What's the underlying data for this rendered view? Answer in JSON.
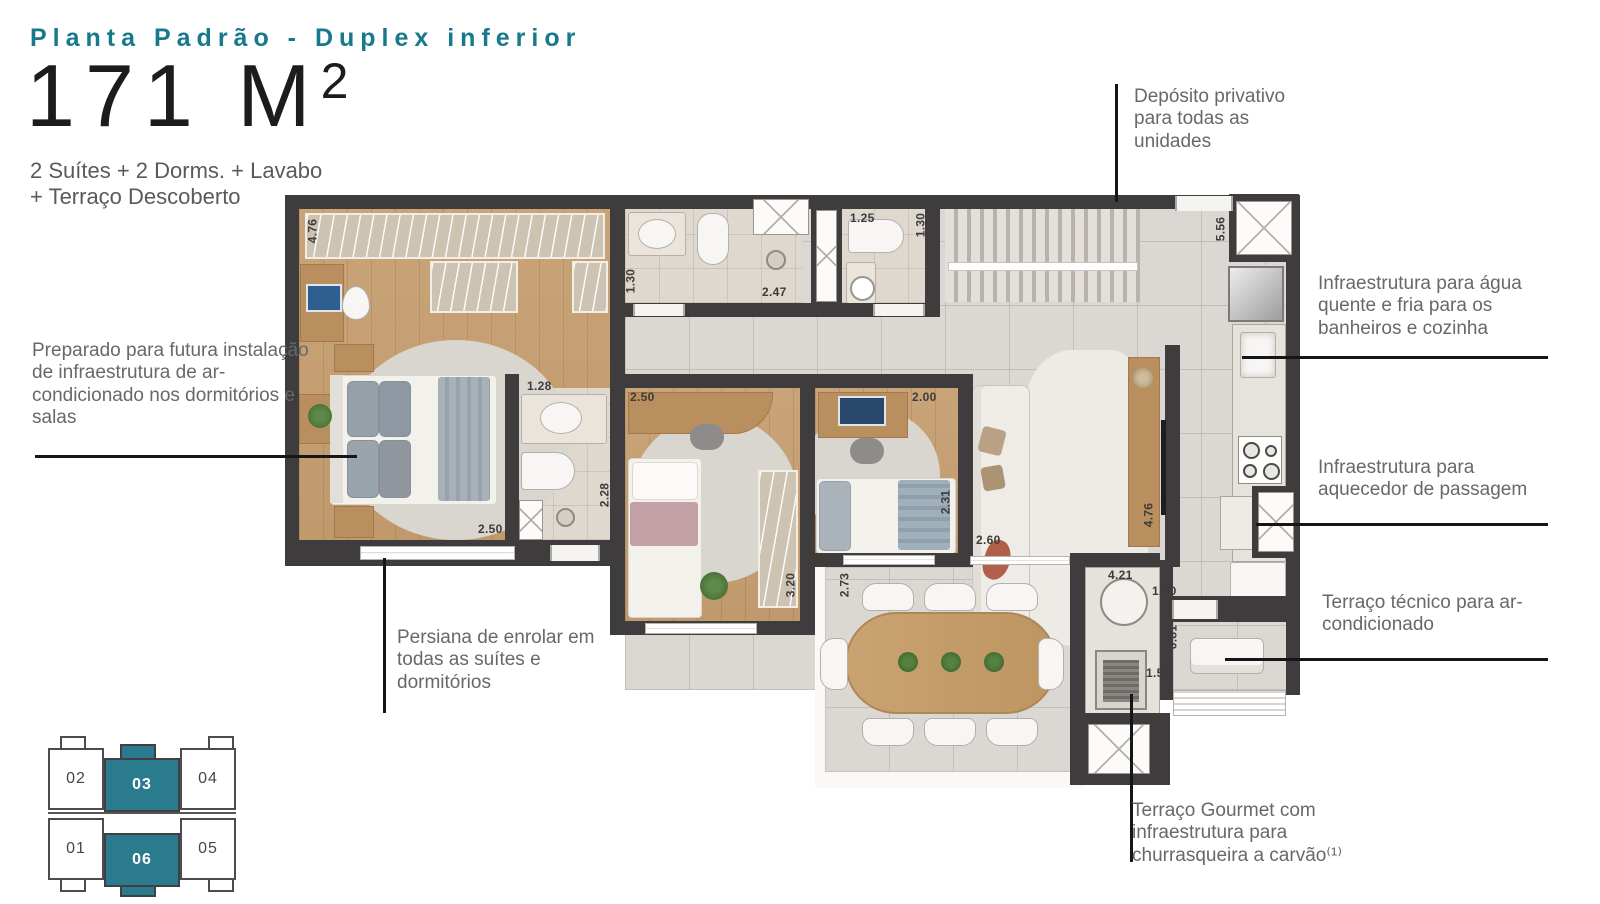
{
  "header": {
    "title": "Planta Padrão - Duplex inferior",
    "area_value": "171 M",
    "area_sup": "2",
    "subtitle_line1": "2 Suítes + 2 Dorms. + Lavabo",
    "subtitle_line2": "+ Terraço Descoberto"
  },
  "annotations": {
    "deposito": "Depósito privativo para todas as unidades",
    "agua": "Infraestrutura para água quente e fria para os banheiros e cozinha",
    "aquecedor": "Infraestrutura para aquecedor de passagem",
    "tecnico": "Terraço técnico para ar-condicionado",
    "gourmet": "Terraço Gourmet com infraestrutura para churrasqueira a carvão⁽¹⁾",
    "preparado": "Preparado para futura instalação de infraestrutura de ar-condicionado nos dormitórios e salas",
    "persiana": "Persiana de enrolar em todas as suítes e dormitórios"
  },
  "plan": {
    "dims": [
      "4.76",
      "1.30",
      "2.47",
      "1.25",
      "1.30",
      "5.56",
      "1.28",
      "2.50",
      "2.00",
      "2.50",
      "2.28",
      "3.20",
      "2.31",
      "2.60",
      "4.76",
      "2.73",
      "4.21",
      "1.60",
      "0.81",
      "1.58"
    ]
  },
  "keyplan": {
    "units": [
      {
        "label": "02",
        "highlighted": false
      },
      {
        "label": "03",
        "highlighted": true
      },
      {
        "label": "04",
        "highlighted": false
      },
      {
        "label": "01",
        "highlighted": false
      },
      {
        "label": "06",
        "highlighted": true
      },
      {
        "label": "05",
        "highlighted": false
      }
    ]
  },
  "colors": {
    "accent_teal": "#1e7a8c",
    "wall": "#3e3c3d",
    "wood_floor": "#c8a173",
    "tile": "#d9d5d0",
    "annotation_text": "#68686a",
    "leader_line": "#161616"
  }
}
